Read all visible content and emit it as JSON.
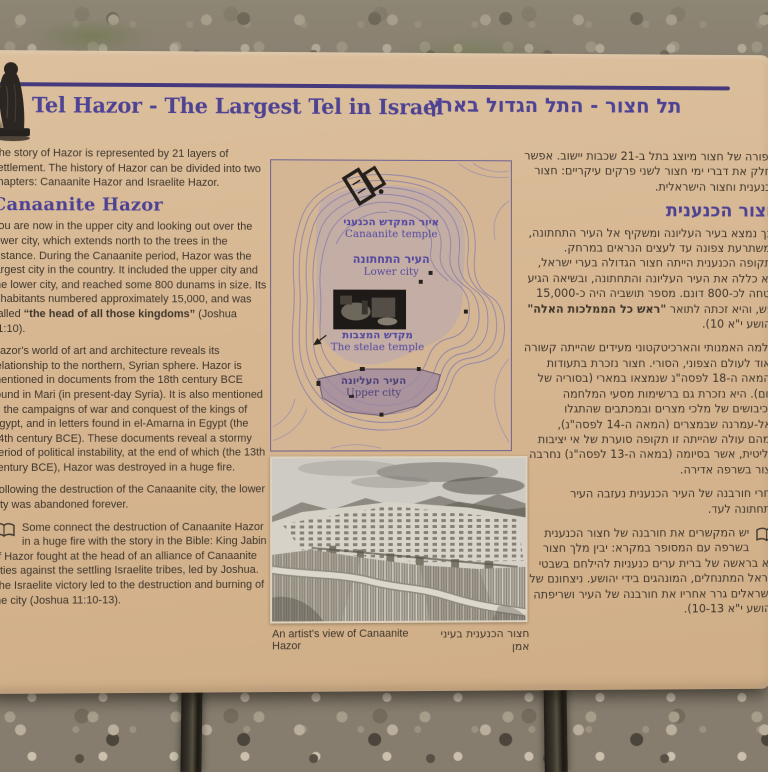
{
  "sign": {
    "title_en": "Tel Hazor - The Largest Tel in Israel",
    "title_he": "תל חצור - התל הגדול בארץ",
    "english": {
      "intro": "The story of Hazor is represented by 21 layers of settlement. The history of Hazor can be divided into two chapters: Canaanite Hazor and Israelite Hazor.",
      "heading": "Canaanite Hazor",
      "p1_before": "You are now in the upper city and looking out over the lower city, which extends north to the trees in the distance. During the Canaanite period, Hazor was the largest city in the country. It included the upper city and the lower city, and reached some 800 dunams in size. Its inhabitants numbered approximately 15,000, and was called ",
      "p1_bold": "“the head of all those kingdoms”",
      "p1_after": " (Joshua 11:10).",
      "p2": "Hazor's world of art and architecture reveals its relationship to the northern, Syrian sphere. Hazor is mentioned in documents from the 18th century BCE found in Mari (in present-day Syria). It is also mentioned in the campaigns of war and conquest of the kings of Egypt, and in letters found in el-Amarna in Egypt (the 14th century BCE). These documents reveal a stormy period of political instability, at the end of which (the 13th century BCE), Hazor was destroyed in a huge fire.",
      "p3": "Following the destruction of the Canaanite city, the lower city was abandoned forever.",
      "bible": "Some connect the destruction of Canaanite Hazor in a huge fire with the story in the Bible: King Jabin of Hazor fought at the head of an alliance of Canaanite cities against the settling Israelite tribes, led by Joshua. The Israelite victory led to the destruction and burning of the city (Joshua 11:10-13)."
    },
    "hebrew": {
      "intro": "סיפורה של חצור מיוצג בתל ב-21 שכבות יישוב. אפשר לחלק את דברי ימי חצור לשני פרקים עיקריים: חצור הכנענית וחצור הישראלית.",
      "heading": "חצור הכנענית",
      "p1_before": "הנך נמצא בעיר העליונה ומשקיף אל העיר התחתונה, המשתרעת צפונה עד לעצים הנראים במרחק. בתקופה הכנענית הייתה חצור הגדולה בערי ישראל, היא כללה את העיר העליונה והתחתונה, ובשיאה הגיע שטחה לכ-800 דונם. מספר תושביה היה כ-15,000 נפש, והיא זכתה לתואר ",
      "p1_bold": "\"ראש כל הממלכות האלה\"",
      "p1_after": " (יהושע י\"א 10).",
      "p2": "עולמה האמנותי והארכיטקטוני מעידים שהייתה קשורה מאוד לעולם הצפוני, הסורי. חצור נזכרת בתעודות מהמאה ה-18 לפסה\"נ שנמצאו במארי (בסוריה של היום). היא נזכרת גם ברשימות מסעי המלחמה והכיבושים של מלכי מצרים ובמכתבים שהתגלו באל-עמרנה שבמצרים (המאה ה-14 לפסה\"נ), שמהם עולה שהייתה זו תקופה סוערת של אי יציבות פוליטית, אשר בסיומה (במאה ה-13 לפסה\"נ) נחרבה חצור בשרפה אדירה.",
      "p3": "אחרי חורבנה של העיר הכנענית נעזבה העיר התחתונה לעד.",
      "bible": "יש המקשרים את חורבנה של חצור הכנענית בשרפה עם המסופר במקרא: יבין מלך חצור יצא בראשה של ברית ערים כנעניות להילחם בשבטי ישראל המתנחלים, המונהגים בידי יהושע. ניצחונם של הישראלים גרר אחריו את חורבנה של העיר ושריפתה (יהושע י\"א 10-13)."
    },
    "map": {
      "canaanite_temple_he": "איור המקדש הכנעני",
      "canaanite_temple_en": "Canaanite temple",
      "lower_city_he": "העיר התחתונה",
      "lower_city_en": "Lower city",
      "stelae_temple_he": "מקדש המצבות",
      "stelae_temple_en": "The stelae temple",
      "upper_city_he": "העיר העליונה",
      "upper_city_en": "Upper city"
    },
    "caption_en": "An artist's view of Canaanite Hazor",
    "caption_he": "חצור הכנענית בעיני אמן",
    "colors": {
      "panel_tan": "#d6b691",
      "accent_purple": "#4e4294",
      "rule_purple": "#43397c",
      "body_text": "#3e352b"
    }
  }
}
